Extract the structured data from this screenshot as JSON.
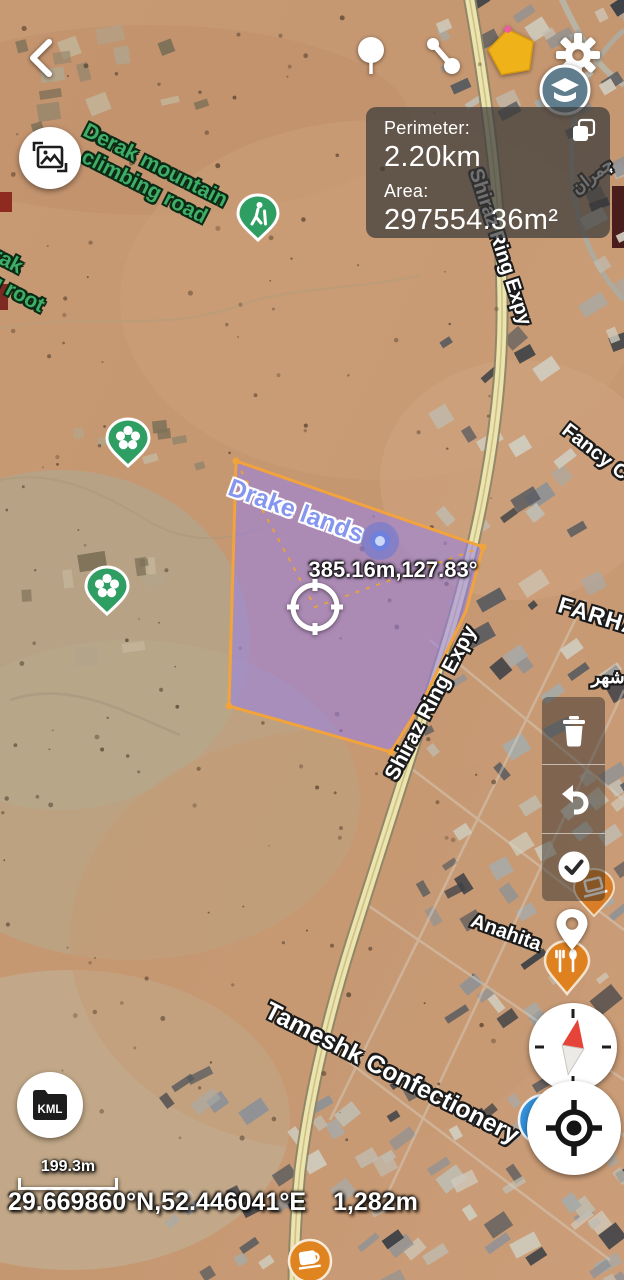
{
  "measure_panel": {
    "perimeter_label": "Perimeter:",
    "perimeter_value": "2.20km",
    "area_label": "Area:",
    "area_value": "297554.36m²"
  },
  "measurement": {
    "segment_text": "385.16m,127.83°"
  },
  "map_labels": {
    "drake_lands": "Drake lands",
    "derak_road_line1": "Derak mountain",
    "derak_road_line2": "climbing road",
    "derak_root_line1": "Derak",
    "derak_root_line2": "climbing root",
    "shiraz_expy_upper": "Shiraz Ring Expy",
    "shiraz_expy_lower": "Shiraz Ring Expy",
    "fancy": "Fancy C",
    "farhad": "FARHA",
    "persian_upper": "چمران",
    "persian_lower": "شهر",
    "anahita": "Anahita",
    "tameshk": "Tameshk Confectionery"
  },
  "footer": {
    "scale_label": "199.3m",
    "coordinates": "29.669860°N,52.446041°E",
    "elevation": "1,282m"
  },
  "buttons": {
    "kml_label": "KML"
  },
  "icons": {
    "back": "chevron-left",
    "top_marker": "map-pin",
    "measure_tool": "two-point-ruler",
    "polygon_tool": "yellow-pentagon",
    "settings": "gear",
    "map_layers": "layers-cap",
    "copy": "copy-squares",
    "photo": "image-frame",
    "trash": "trash-can",
    "undo": "undo-arrow",
    "confirm": "check-circle",
    "placed_marker": "pin-outline",
    "compass": "compass-needle",
    "my_location": "gps-target",
    "kml": "folder",
    "hiking_poi": "hiker",
    "park_poi": "flower",
    "restaurant_poi": "cutlery",
    "shop_poi": "laptop",
    "cafe_poi": "coffee-cup",
    "mosque_poi": "blue-badge",
    "gps_dot": "blue-dot",
    "center_marker": "target-crosshair"
  },
  "colors": {
    "polygon_fill": "#9583ea",
    "polygon_stroke": "#f2a33c",
    "pin_green": "#2f9e63",
    "poi_orange": "#e0811f",
    "poi_blue": "#3390d9",
    "road_yellow": "#ece4ad",
    "label_green": "#3fae66",
    "drake_blue": "#8695ef",
    "polygon_tool_yellow": "#f0b219",
    "compass_needle_red": "#e64438",
    "panel_bg": "rgba(58,58,58,0.72)"
  }
}
